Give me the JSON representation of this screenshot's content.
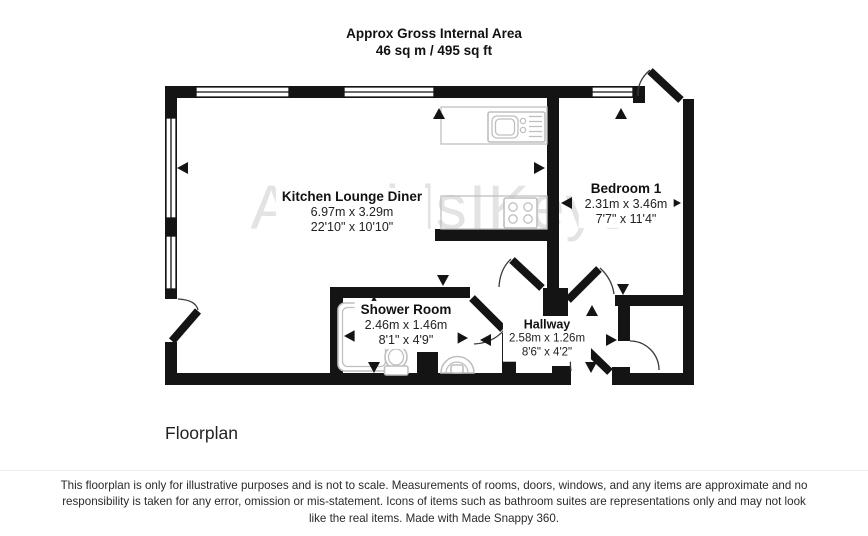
{
  "header": {
    "line1": "Approx Gross Internal Area",
    "line2": "46 sq m / 495 sq ft"
  },
  "watermark": {
    "left": "Arnolds",
    "right": "Keys"
  },
  "rooms": [
    {
      "name": "Kitchen Lounge Diner",
      "metric": "6.97m x 3.29m",
      "imperial": "22'10\" x 10'10\""
    },
    {
      "name": "Bedroom 1",
      "metric": "2.31m x 3.46m",
      "imperial": "7'7\" x 11'4\""
    },
    {
      "name": "Shower Room",
      "metric": "2.46m x 1.46m",
      "imperial": "8'1\" x 4'9\""
    },
    {
      "name": "Hallway",
      "metric": "2.58m x 1.26m",
      "imperial": "8'6\" x 4'2\""
    }
  ],
  "caption": "Floorplan",
  "footer": {
    "disclaimer": "This floorplan is only for illustrative purposes and is not to scale. Measurements of rooms, doors, windows, and any items are approximate and no responsibility is taken for any error, omission or mis-statement. Icons of items such as bathroom suites are representations only and may not look like the real items. Made with Made Snappy 360."
  },
  "colors": {
    "wall": "#141414",
    "fixture": "#bfbfbf",
    "watermark": "#e3e3e3"
  }
}
